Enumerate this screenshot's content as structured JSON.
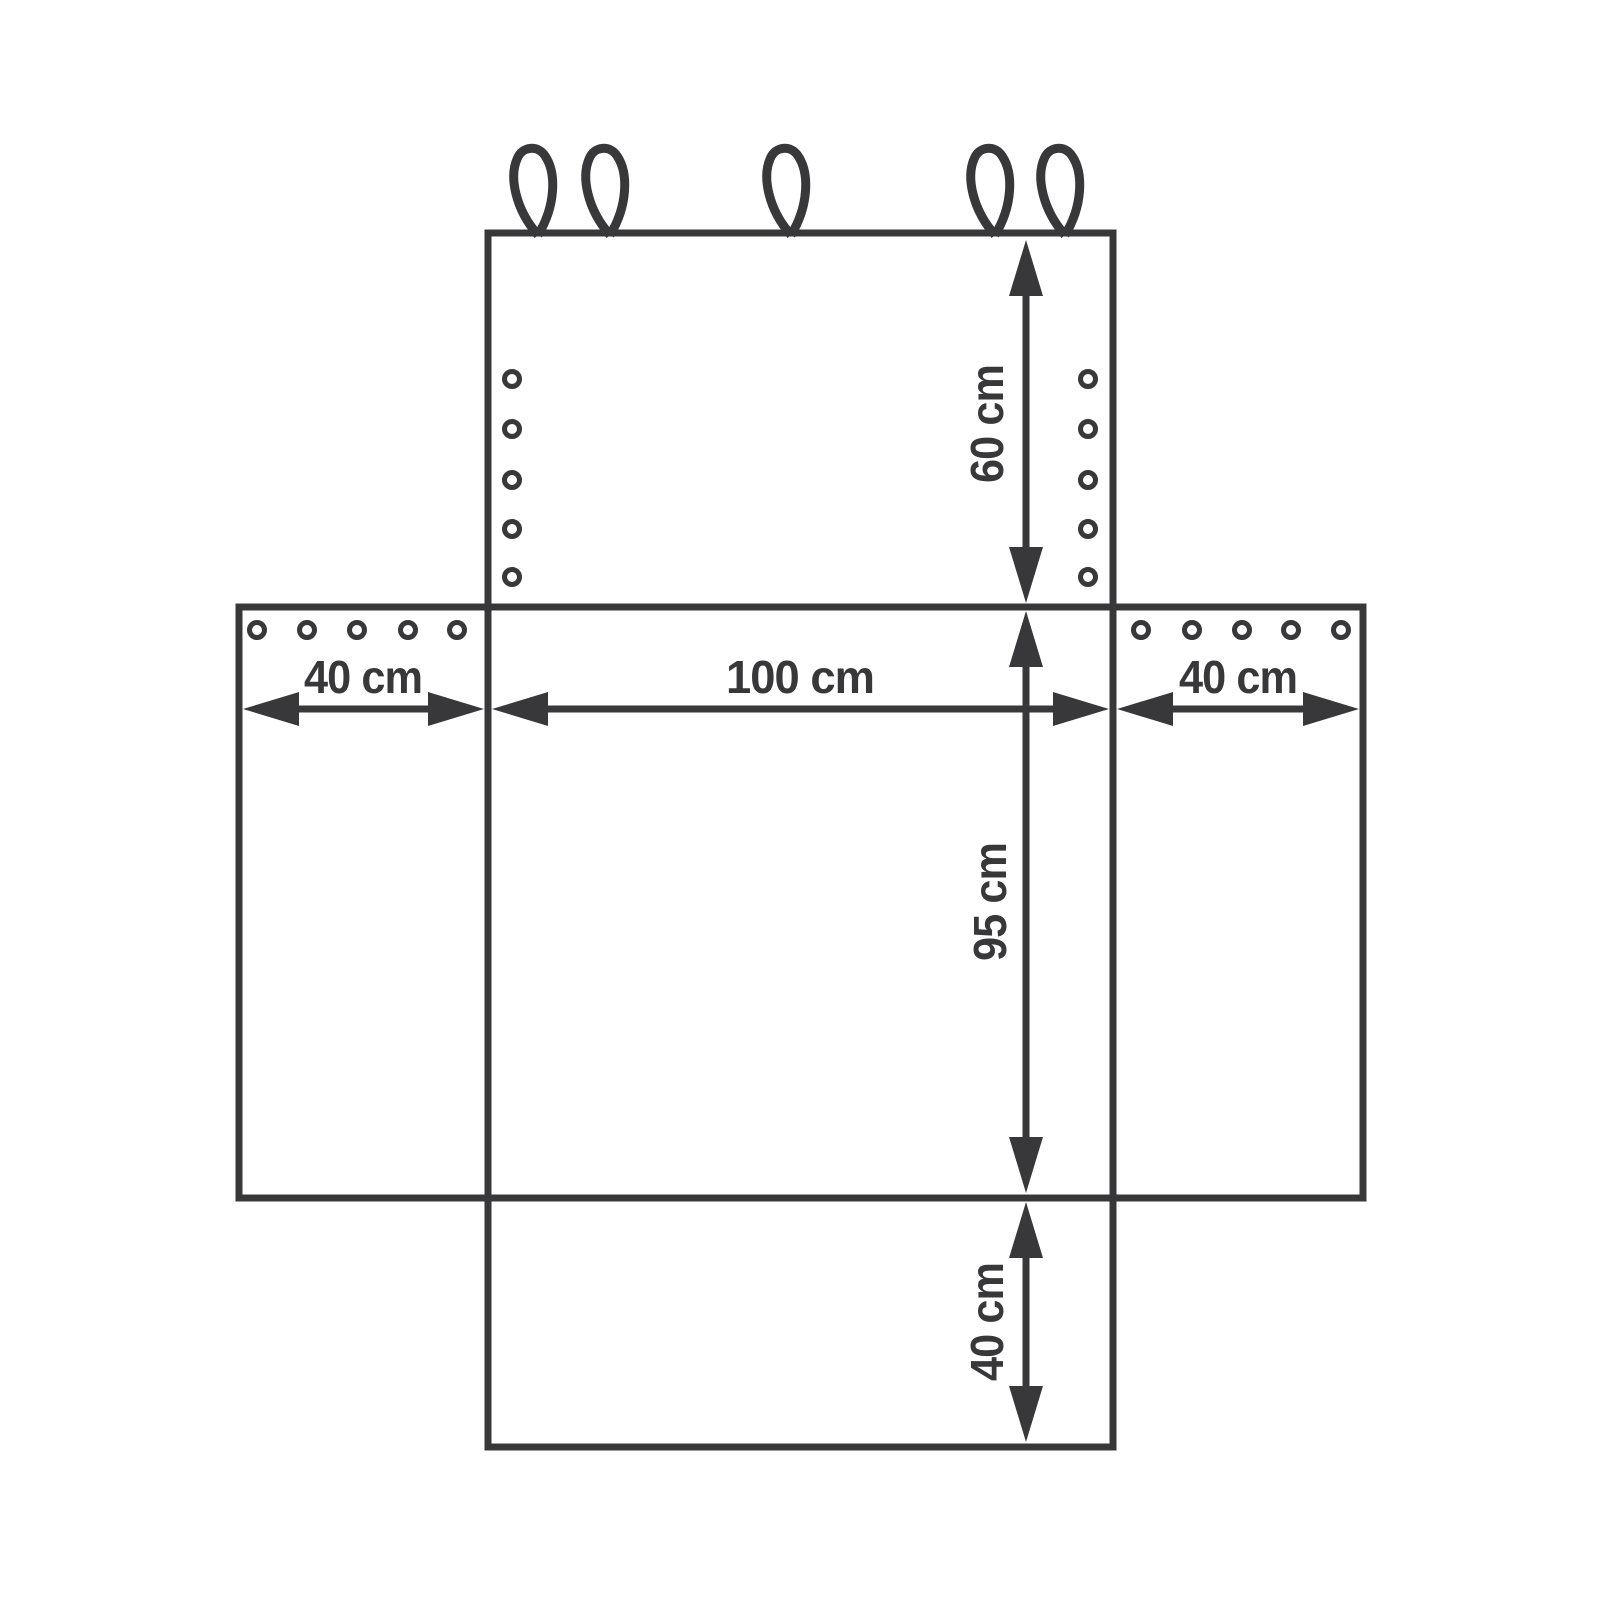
{
  "diagram": {
    "type": "flat-pattern dimensional drawing of a seat cover",
    "colors": {
      "line": "#38383a",
      "background": "#ffffff"
    },
    "dimensions": {
      "top_panel_height": "60 cm",
      "center_panel_width": "100 cm",
      "left_flap_width": "40 cm",
      "right_flap_width": "40 cm",
      "center_panel_height": "95 cm",
      "bottom_panel_height": "40 cm"
    },
    "features": {
      "hanging_loops_count": 5,
      "top_panel_eyelets_per_column": 5,
      "left_flap_eyelets_count": 5,
      "right_flap_eyelets_count": 5
    }
  }
}
